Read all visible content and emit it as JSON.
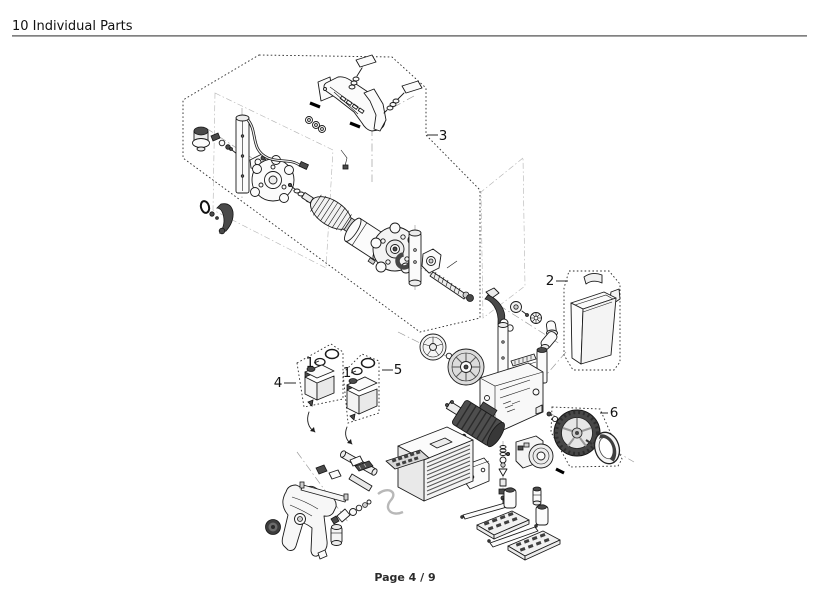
{
  "header": {
    "title": "10 Individual Parts"
  },
  "footer": {
    "page_label": "Page 4 / 9"
  },
  "diagram": {
    "type": "exploded-parts-diagram",
    "description_visible_text_only": true,
    "callouts": [
      {
        "label": "1"
      },
      {
        "label": "1"
      },
      {
        "label": "2"
      },
      {
        "label": "3"
      },
      {
        "label": "4"
      },
      {
        "label": "5"
      },
      {
        "label": "6"
      }
    ],
    "colors": {
      "ink": "#1a1a1a",
      "paper": "#ffffff",
      "rule": "#8f8f8f"
    }
  }
}
